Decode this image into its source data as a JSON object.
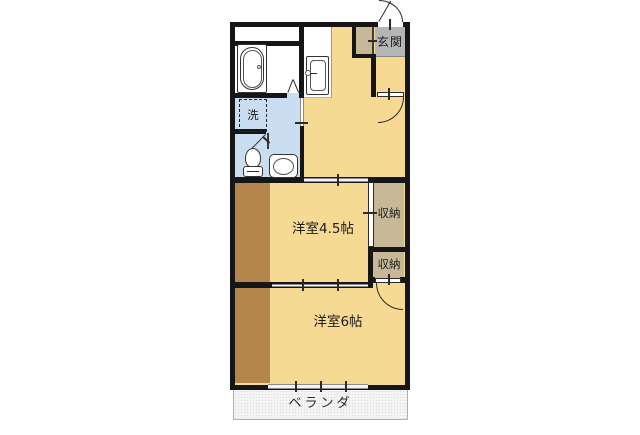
{
  "floorplan": {
    "type": "japanese-apartment-floor-plan",
    "labels": {
      "entrance": "玄関",
      "laundry": "洗",
      "storage_upper": "収納",
      "storage_lower": "収納",
      "room_45": "洋室4.5帖",
      "room_6": "洋室6帖",
      "veranda": "ベランダ"
    },
    "fixtures": {
      "bathtub": "bathtub-icon",
      "kitchen_sink": "kitchen-sink-icon",
      "toilet": "toilet-icon",
      "wash_basin": "wash-basin-icon",
      "washing_machine_space": "washing-machine-space-icon"
    },
    "colors": {
      "room_floor": "#f6d993",
      "flooring_strip": "#b5854e",
      "storage": "#c7b897",
      "entrance_mat": "#b5b5b5",
      "wet_area": "#cbdef1",
      "wall": "#161616",
      "veranda_bg": "#f4f4f4"
    }
  }
}
